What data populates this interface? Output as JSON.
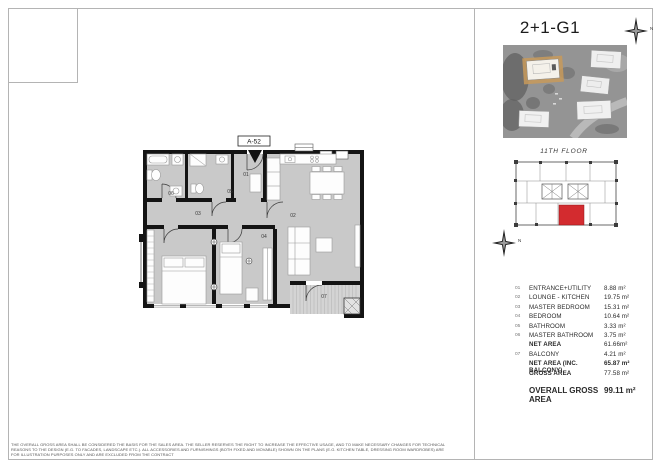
{
  "header": {
    "title": "2+1-G1",
    "north_label": "N"
  },
  "plan": {
    "unit_tag": "A-52",
    "room_labels": [
      "01",
      "02",
      "03",
      "04",
      "05",
      "06",
      "07"
    ]
  },
  "keyplan": {
    "floor_label": "11TH FLOOR",
    "north_label": "N",
    "highlight_color": "#d32b2f"
  },
  "area_table": {
    "rows": [
      {
        "num": "01",
        "name": "ENTRANCE+UTILITY",
        "value": "8.88 m²"
      },
      {
        "num": "02",
        "name": "LOUNGE - KITCHEN",
        "value": "19.75 m²"
      },
      {
        "num": "03",
        "name": "MASTER BEDROOM",
        "value": "15.31 m²"
      },
      {
        "num": "04",
        "name": "BEDROOM",
        "value": "10.64 m²"
      },
      {
        "num": "05",
        "name": "BATHROOM",
        "value": "3.33 m²"
      },
      {
        "num": "06",
        "name": "MASTER BATHROOM",
        "value": "3.75 m²"
      },
      {
        "num": "",
        "name": "NET AREA",
        "value": "61.66m²"
      },
      {
        "num": "07",
        "name": "BALCONY",
        "value": "4.21 m²"
      },
      {
        "num": "",
        "name": "NET AREA (INC. BALCONY)",
        "value": "65.87 m²"
      },
      {
        "num": "",
        "name": "GROSS AREA",
        "value": "77.58 m²"
      }
    ],
    "overall": {
      "label": "OVERALL GROSS AREA",
      "value": "99.11 m²"
    }
  },
  "footer": {
    "disclaimer": "THE OVERALL GROSS AREA SHALL BE CONSIDERED THE BASIS FOR THE SALES AREA. THE SELLER RESERVES THE RIGHT TO INCREASE THE EFFECTIVE USAGE, AND TO MAKE NECESSARY CHANGES FOR TECHNICAL REASONS TO THE DESIGN (E.G. TO FACADES, LANDSCAPE ETC.). ALL ACCESSORIES AND FURNISHINGS (BOTH FIXED AND MOVABLE) SHOWN ON THE PLANS (E.G. KITCHEN TABLE, DRESSING ROOM WARDROBES) ARE FOR ILLUSTRATION PURPOSES ONLY AND ARE EXCLUDED FROM THE CONTRACT"
  }
}
